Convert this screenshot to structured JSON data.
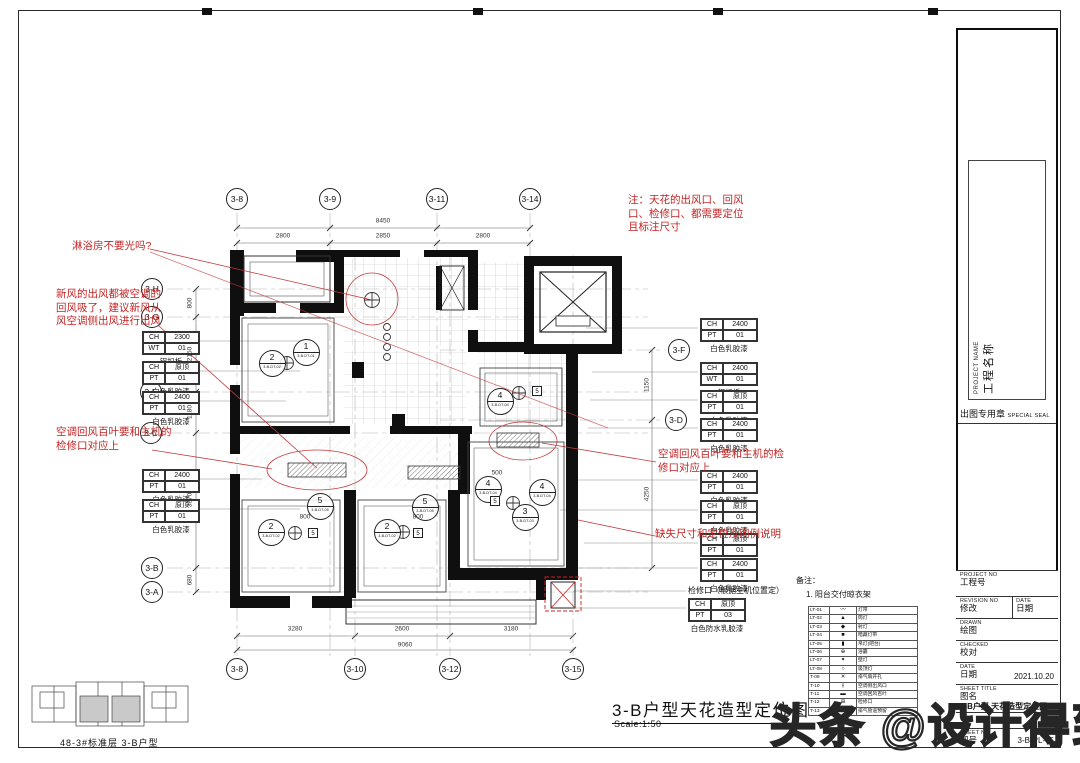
{
  "titleblock": {
    "project_name_en": "PROJECT NAME",
    "project_name_cn": "工程名称",
    "seal_cn": "出图专用章",
    "seal_en": "SPECIAL SEAL",
    "project_no_en": "PROJECT NO",
    "project_no_cn": "工程号",
    "revision_en": "REVISION NO",
    "revision_cn": "修改",
    "rev_date_en": "DATE",
    "rev_date_cn": "日期",
    "drawn_en": "DRAWN",
    "drawn_cn": "绘图",
    "checked_en": "CHECKED",
    "checked_cn": "校对",
    "date_en": "DATE",
    "date_cn": "日期",
    "date_value": "2021.10.20",
    "sheet_title_en": "SHEET TITLE",
    "sheet_title_cn": "图名",
    "sheet_title_value": "3-B户型 天花造型定位图",
    "sheet_no_en": "SHEET NO",
    "sheet_no_cn": "图号",
    "sheet_no_value": "3-B-PL-05"
  },
  "main_title": {
    "text": "3-B户型天花造型定位图",
    "scale": "Scale:1:50"
  },
  "keyplan": {
    "caption": "48-3#标准层 3-B户型"
  },
  "watermark": {
    "text": "头条 @设计得到"
  },
  "red_notes": [
    {
      "x": 72,
      "y": 240,
      "w": 140,
      "text": "淋浴房不要光吗?"
    },
    {
      "x": 56,
      "y": 288,
      "w": 112,
      "text": "新风的出风都被空调的回风吸了，建议新风从风空调侧出风进行出风"
    },
    {
      "x": 56,
      "y": 426,
      "w": 118,
      "text": "空调回风百叶要和主机的检修口对应上"
    },
    {
      "x": 628,
      "y": 194,
      "w": 122,
      "text": "注：天花的出风口、回风口、检修口、都需要定位且标注尺寸"
    },
    {
      "x": 658,
      "y": 448,
      "w": 132,
      "text": "空调回风百叶要和主机的检修口对应上"
    },
    {
      "x": 655,
      "y": 528,
      "w": 170,
      "text": "缺失尺寸和定位及图例说明"
    }
  ],
  "labels": [
    {
      "x": 688,
      "y": 585,
      "text": "检修口（根据主机位置定）"
    },
    {
      "x": 796,
      "y": 575,
      "text": "备注："
    },
    {
      "x": 806,
      "y": 589,
      "text": "1. 阳台交付晾衣架"
    }
  ],
  "grid_bubbles": [
    {
      "label": "3-8",
      "x": 237,
      "y": 199
    },
    {
      "label": "3-9",
      "x": 330,
      "y": 199
    },
    {
      "label": "3-11",
      "x": 437,
      "y": 199
    },
    {
      "label": "3-14",
      "x": 530,
      "y": 199
    },
    {
      "label": "3-8",
      "x": 237,
      "y": 669
    },
    {
      "label": "3-10",
      "x": 355,
      "y": 669
    },
    {
      "label": "3-12",
      "x": 450,
      "y": 669
    },
    {
      "label": "3-15",
      "x": 573,
      "y": 669
    },
    {
      "label": "3-H",
      "x": 152,
      "y": 289
    },
    {
      "label": "3-G",
      "x": 152,
      "y": 317
    },
    {
      "label": "3-E",
      "x": 151,
      "y": 392
    },
    {
      "label": "3-C",
      "x": 151,
      "y": 433
    },
    {
      "label": "3-B",
      "x": 152,
      "y": 568
    },
    {
      "label": "3-A",
      "x": 152,
      "y": 592
    },
    {
      "label": "3-F",
      "x": 679,
      "y": 350
    },
    {
      "label": "3-D",
      "x": 676,
      "y": 420
    }
  ],
  "finish_tags": [
    {
      "x": 142,
      "y": 331,
      "k1": "CH",
      "v1": "2300",
      "k2": "WT",
      "v2": "01",
      "cap": "铝扣板"
    },
    {
      "x": 142,
      "y": 361,
      "k1": "CH",
      "v1": "原顶",
      "k2": "PT",
      "v2": "01",
      "cap": "白色乳胶漆"
    },
    {
      "x": 142,
      "y": 391,
      "k1": "CH",
      "v1": "2400",
      "k2": "PT",
      "v2": "01",
      "cap": "白色乳胶漆"
    },
    {
      "x": 142,
      "y": 469,
      "k1": "CH",
      "v1": "2400",
      "k2": "PT",
      "v2": "01",
      "cap": "白色乳胶漆"
    },
    {
      "x": 142,
      "y": 499,
      "k1": "CH",
      "v1": "原顶",
      "k2": "PT",
      "v2": "01",
      "cap": "白色乳胶漆"
    },
    {
      "x": 700,
      "y": 318,
      "k1": "CH",
      "v1": "2400",
      "k2": "PT",
      "v2": "01",
      "cap": "白色乳胶漆"
    },
    {
      "x": 700,
      "y": 362,
      "k1": "CH",
      "v1": "2400",
      "k2": "WT",
      "v2": "01",
      "cap": "铝扣板"
    },
    {
      "x": 700,
      "y": 390,
      "k1": "CH",
      "v1": "原顶",
      "k2": "PT",
      "v2": "01",
      "cap": "白色乳胶漆"
    },
    {
      "x": 700,
      "y": 418,
      "k1": "CH",
      "v1": "2400",
      "k2": "PT",
      "v2": "01",
      "cap": "白色乳胶漆"
    },
    {
      "x": 700,
      "y": 470,
      "k1": "CH",
      "v1": "2400",
      "k2": "PT",
      "v2": "01",
      "cap": "白色乳胶漆"
    },
    {
      "x": 700,
      "y": 500,
      "k1": "CH",
      "v1": "原顶",
      "k2": "PT",
      "v2": "01",
      "cap": "白色乳胶漆"
    },
    {
      "x": 700,
      "y": 533,
      "k1": "CH",
      "v1": "原顶",
      "k2": "PT",
      "v2": "01",
      "cap": "白色乳胶漆"
    },
    {
      "x": 700,
      "y": 558,
      "k1": "CH",
      "v1": "2400",
      "k2": "PT",
      "v2": "01",
      "cap": "白色乳胶漆"
    },
    {
      "x": 688,
      "y": 598,
      "k1": "CH",
      "v1": "原顶",
      "k2": "PT",
      "v2": "03",
      "cap": "白色防水乳胶漆"
    }
  ],
  "callouts": [
    {
      "x": 306,
      "y": 352,
      "num": "1",
      "ref": "3-B-DT-01"
    },
    {
      "x": 272,
      "y": 363,
      "num": "2",
      "ref": "3-B-DT-02"
    },
    {
      "x": 271,
      "y": 532,
      "num": "2",
      "ref": "3-B-DT-02"
    },
    {
      "x": 320,
      "y": 506,
      "num": "5",
      "ref": "3-B-DT-05"
    },
    {
      "x": 387,
      "y": 532,
      "num": "2",
      "ref": "3-B-DT-02"
    },
    {
      "x": 425,
      "y": 507,
      "num": "5",
      "ref": "3-B-DT-05"
    },
    {
      "x": 500,
      "y": 401,
      "num": "4",
      "ref": "3-B-DT-04"
    },
    {
      "x": 488,
      "y": 489,
      "num": "4",
      "ref": "3-B-DT-04"
    },
    {
      "x": 542,
      "y": 492,
      "num": "4",
      "ref": "3-B-DT-04"
    },
    {
      "x": 525,
      "y": 517,
      "num": "3",
      "ref": "3-B-DT-03"
    }
  ],
  "squares": [
    {
      "x": 313,
      "y": 533,
      "num": "5"
    },
    {
      "x": 418,
      "y": 533,
      "num": "5"
    },
    {
      "x": 495,
      "y": 501,
      "num": "5"
    },
    {
      "x": 537,
      "y": 391,
      "num": "5"
    }
  ],
  "dims": [
    {
      "x": 283,
      "y": 236,
      "t": "2800"
    },
    {
      "x": 383,
      "y": 236,
      "t": "2850"
    },
    {
      "x": 483,
      "y": 236,
      "t": "2800"
    },
    {
      "x": 383,
      "y": 221,
      "t": "8450"
    },
    {
      "x": 295,
      "y": 629,
      "t": "3280"
    },
    {
      "x": 402,
      "y": 629,
      "t": "2600"
    },
    {
      "x": 511,
      "y": 629,
      "t": "3180"
    },
    {
      "x": 405,
      "y": 645,
      "t": "9060"
    },
    {
      "x": 190,
      "y": 303,
      "t": "800",
      "r": 1
    },
    {
      "x": 190,
      "y": 354,
      "t": "2150",
      "r": 1
    },
    {
      "x": 190,
      "y": 412,
      "t": "1180",
      "r": 1
    },
    {
      "x": 190,
      "y": 500,
      "t": "3870",
      "r": 1
    },
    {
      "x": 190,
      "y": 580,
      "t": "680",
      "r": 1
    },
    {
      "x": 647,
      "y": 385,
      "t": "1150",
      "r": 1
    },
    {
      "x": 647,
      "y": 494,
      "t": "4250",
      "r": 1
    },
    {
      "x": 305,
      "y": 517,
      "t": "800"
    },
    {
      "x": 418,
      "y": 517,
      "t": "800"
    },
    {
      "x": 497,
      "y": 473,
      "t": "500"
    }
  ],
  "legend": {
    "rows": [
      {
        "code": "LT-01",
        "sym": "〰",
        "desc": "灯带"
      },
      {
        "code": "LT-02",
        "sym": "▲",
        "desc": "筒灯"
      },
      {
        "code": "LT-03",
        "sym": "◆",
        "desc": "射灯"
      },
      {
        "code": "LT-04",
        "sym": "■",
        "desc": "暗藏灯带"
      },
      {
        "code": "LT-05",
        "sym": "▮",
        "desc": "吊灯(吧台)"
      },
      {
        "code": "LT-06",
        "sym": "⊕",
        "desc": "浴霸"
      },
      {
        "code": "LT-07",
        "sym": "✦",
        "desc": "壁灯"
      },
      {
        "code": "LT-08",
        "sym": "○",
        "desc": "吸顶灯"
      },
      {
        "code": "T-09",
        "sym": "✕",
        "desc": "排气扇开孔"
      },
      {
        "code": "T-10",
        "sym": "⫲",
        "desc": "空调侧出风口"
      },
      {
        "code": "T-11",
        "sym": "▬",
        "desc": "空调回风百叶"
      },
      {
        "code": "T-12",
        "sym": "⊞",
        "desc": "检修口"
      },
      {
        "code": "T-13",
        "sym": "⊡",
        "desc": "排气管道预留"
      }
    ]
  }
}
